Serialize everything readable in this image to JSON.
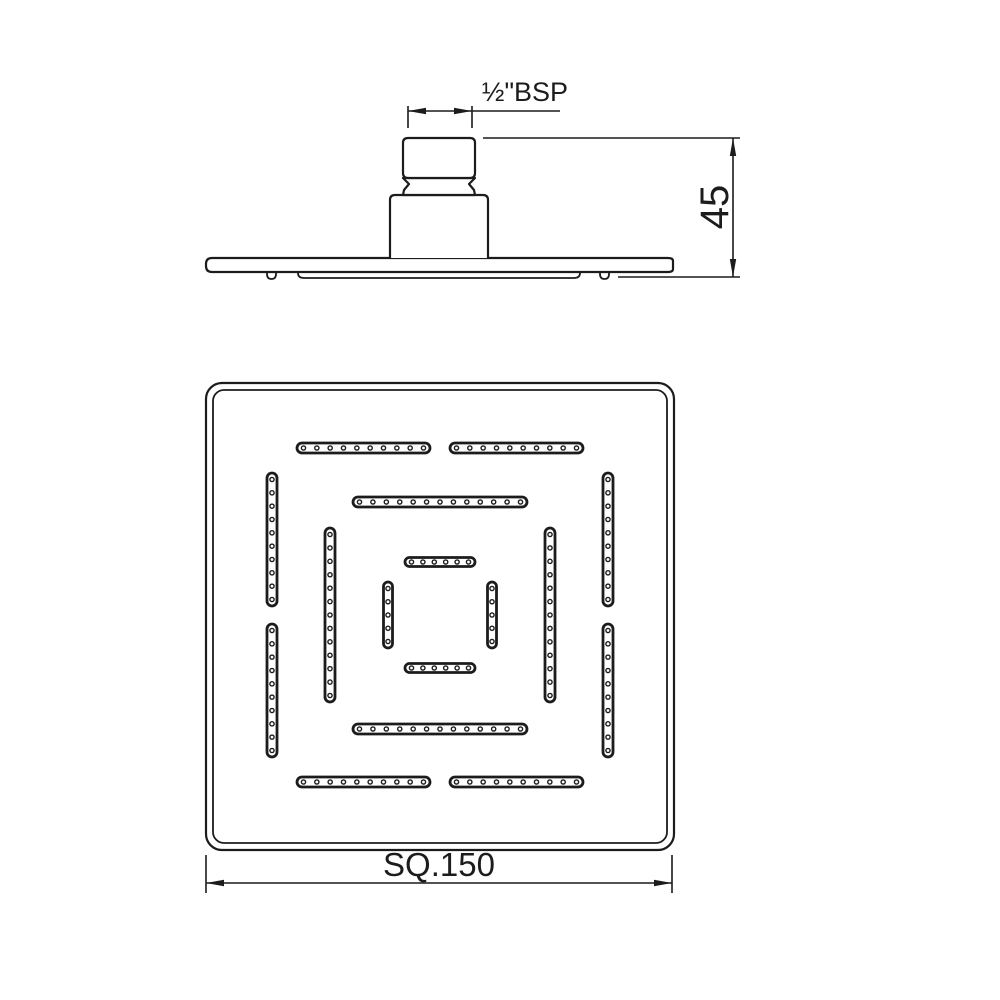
{
  "colors": {
    "background": "#ffffff",
    "line_color": "#1c1c1c"
  },
  "dimensions": {
    "thread_label": "½\"BSP",
    "height_label": "45",
    "face_label": "SQ.150"
  },
  "plan_view": {
    "dot_inset": 6.5,
    "nozzle_radius": 2.1,
    "slots": [
      {
        "ring": "outer",
        "o": "h",
        "a": 297,
        "b": 430,
        "c": 448,
        "n": 10,
        "r": 5
      },
      {
        "ring": "outer",
        "o": "h",
        "a": 450,
        "b": 583,
        "c": 448,
        "n": 10,
        "r": 5
      },
      {
        "ring": "outer",
        "o": "h",
        "a": 297,
        "b": 430,
        "c": 782,
        "n": 10,
        "r": 5
      },
      {
        "ring": "outer",
        "o": "h",
        "a": 450,
        "b": 583,
        "c": 782,
        "n": 10,
        "r": 5
      },
      {
        "ring": "outer",
        "o": "v",
        "a": 473,
        "b": 606,
        "c": 272,
        "n": 10,
        "r": 5
      },
      {
        "ring": "outer",
        "o": "v",
        "a": 624,
        "b": 757,
        "c": 272,
        "n": 10,
        "r": 5
      },
      {
        "ring": "outer",
        "o": "v",
        "a": 473,
        "b": 606,
        "c": 608,
        "n": 10,
        "r": 5
      },
      {
        "ring": "outer",
        "o": "v",
        "a": 624,
        "b": 757,
        "c": 608,
        "n": 10,
        "r": 5
      },
      {
        "ring": "middle",
        "o": "h",
        "a": 353,
        "b": 527,
        "c": 502,
        "n": 13,
        "r": 5
      },
      {
        "ring": "middle",
        "o": "h",
        "a": 353,
        "b": 527,
        "c": 729,
        "n": 13,
        "r": 5
      },
      {
        "ring": "middle",
        "o": "v",
        "a": 528,
        "b": 702,
        "c": 330,
        "n": 13,
        "r": 5
      },
      {
        "ring": "middle",
        "o": "v",
        "a": 528,
        "b": 702,
        "c": 550,
        "n": 13,
        "r": 5
      },
      {
        "ring": "inner",
        "o": "h",
        "a": 405,
        "b": 475,
        "c": 562,
        "n": 6,
        "r": 4.5
      },
      {
        "ring": "inner",
        "o": "h",
        "a": 405,
        "b": 475,
        "c": 668,
        "n": 6,
        "r": 4.5
      },
      {
        "ring": "inner",
        "o": "v",
        "a": 582,
        "b": 648,
        "c": 388,
        "n": 5,
        "r": 4.5
      },
      {
        "ring": "inner",
        "o": "v",
        "a": 582,
        "b": 648,
        "c": 492,
        "n": 5,
        "r": 4.5
      }
    ]
  }
}
